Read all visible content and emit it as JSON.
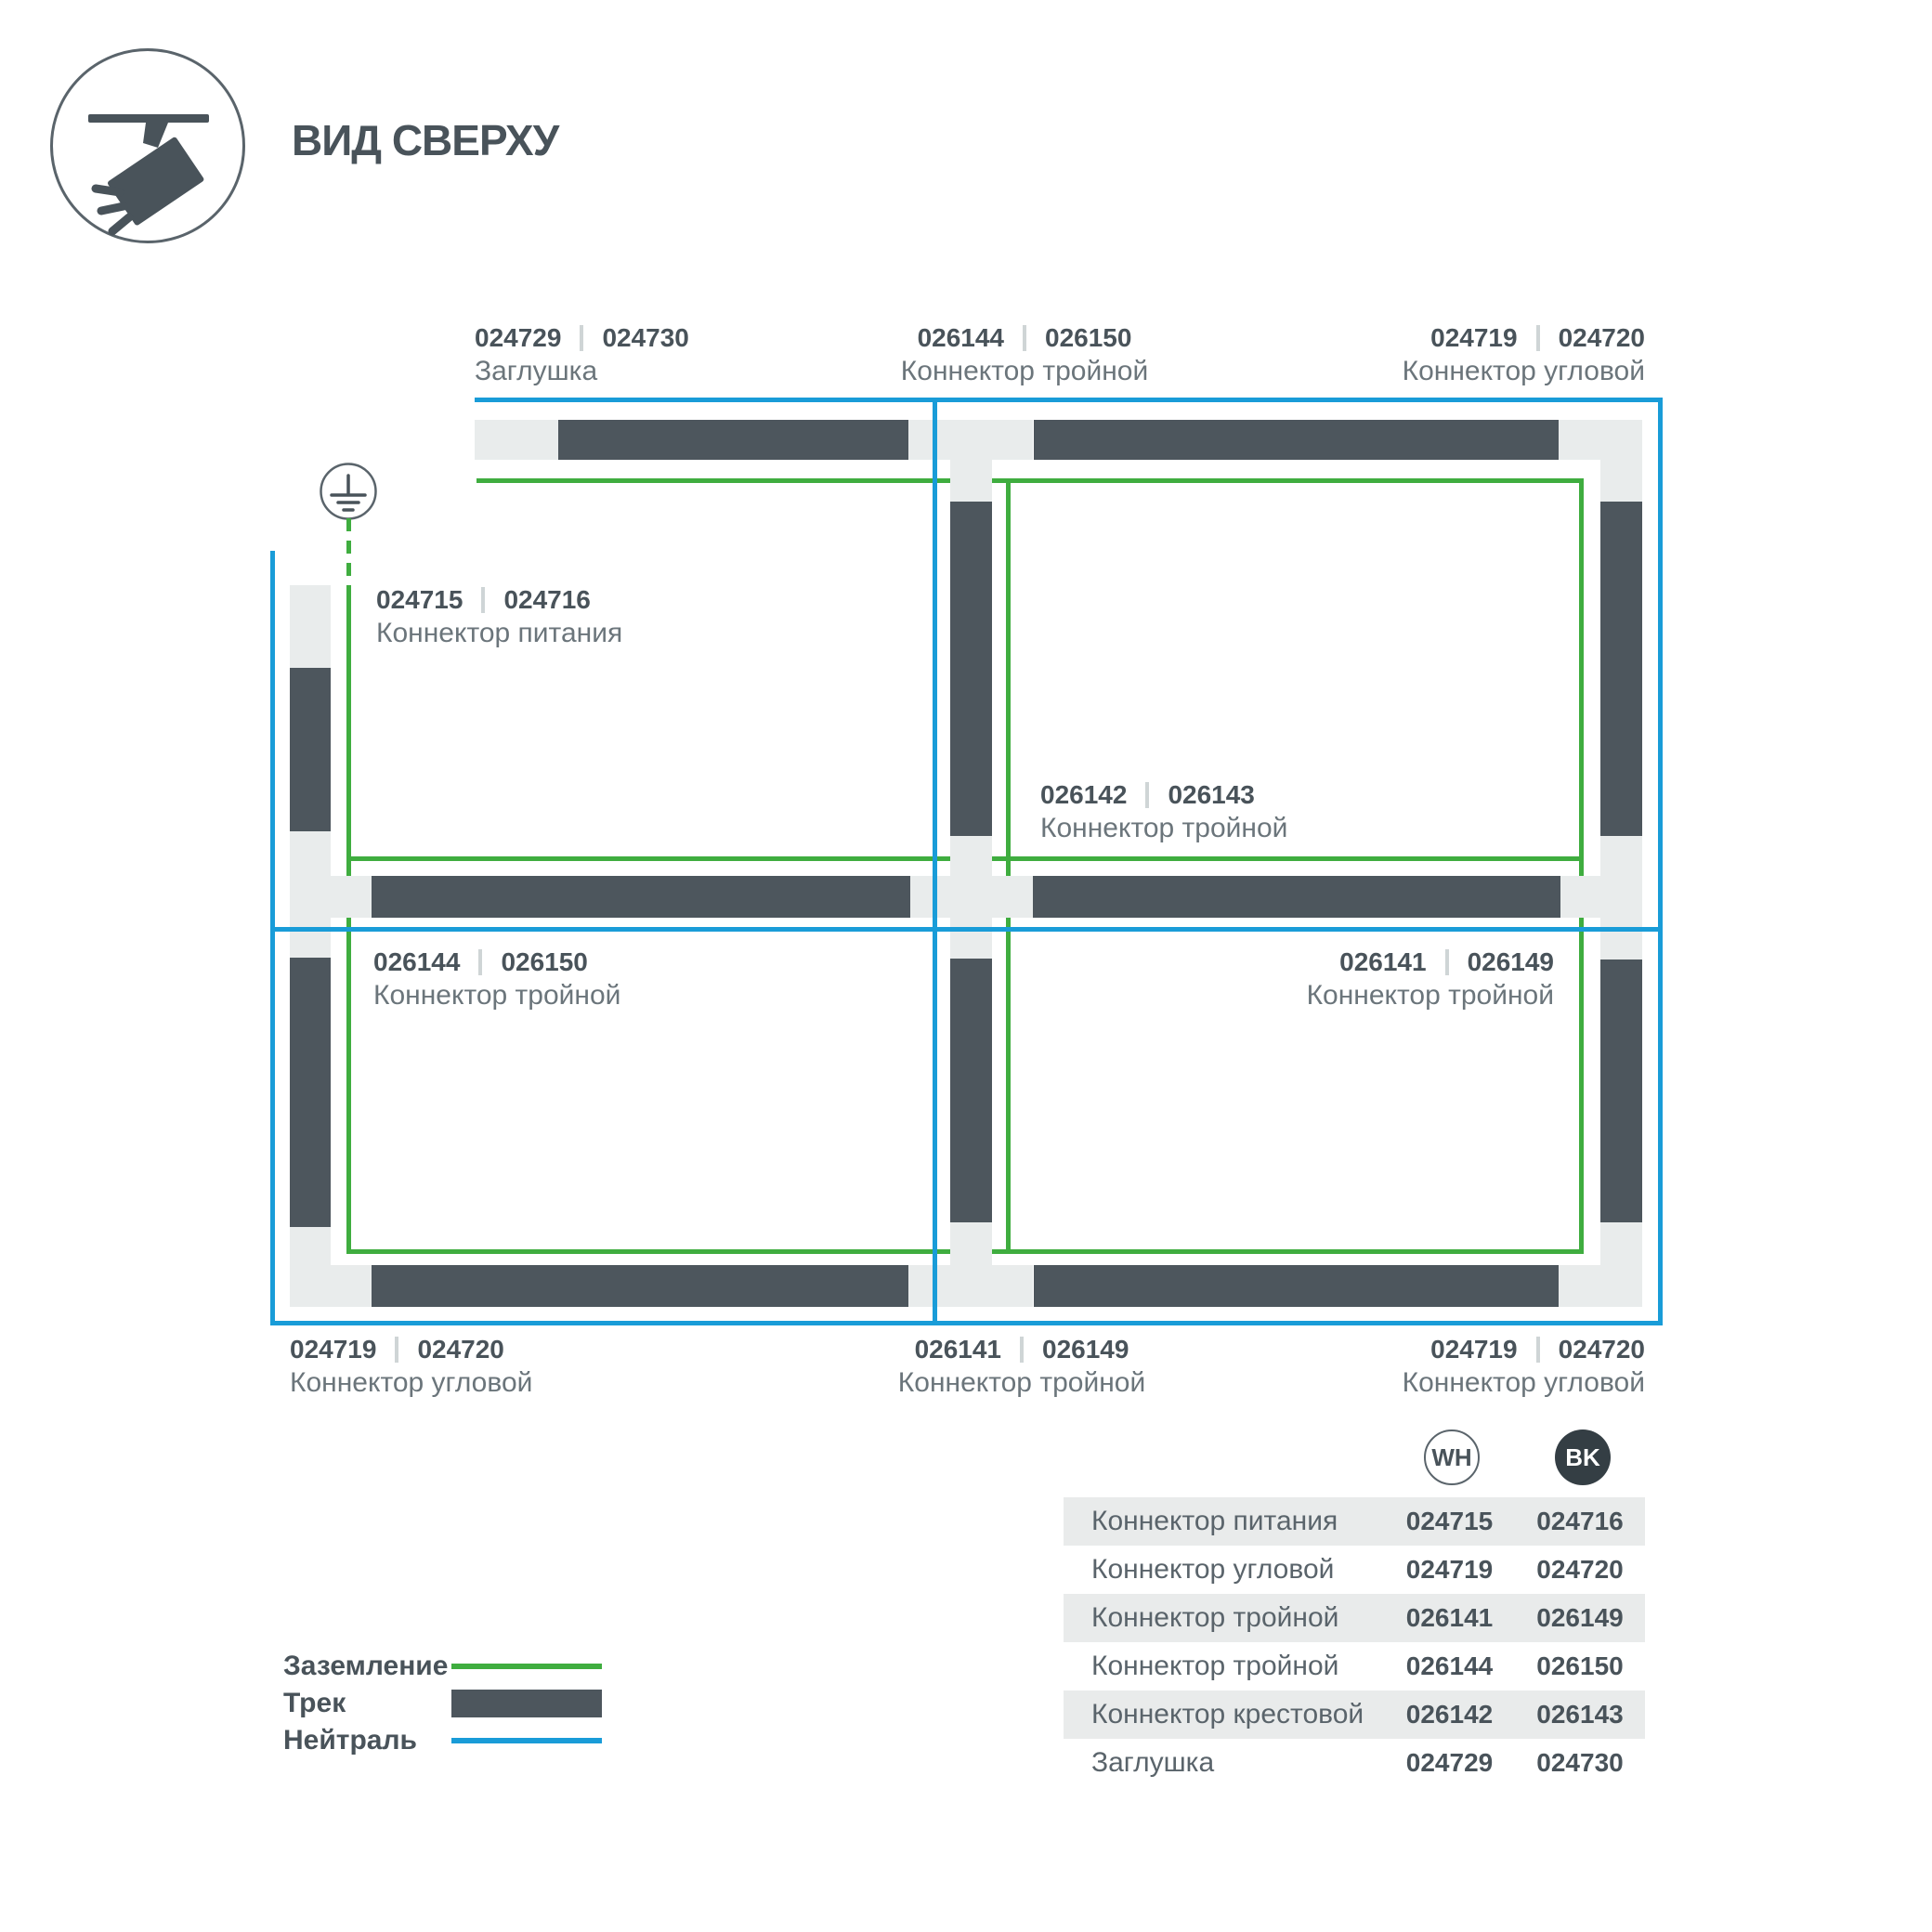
{
  "header": {
    "title": "ВИД СВЕРХУ",
    "icon": "track-spotlight-icon"
  },
  "diagram": {
    "ground_icon": "earth-ground-icon",
    "labels": {
      "top_left": {
        "code_wh": "024729",
        "code_bk": "024730",
        "name": "Заглушка"
      },
      "top_center": {
        "code_wh": "026144",
        "code_bk": "026150",
        "name": "Коннектор тройной"
      },
      "top_right": {
        "code_wh": "024719",
        "code_bk": "024720",
        "name": "Коннектор угловой"
      },
      "cell_top_left": {
        "code_wh": "024715",
        "code_bk": "024716",
        "name": "Коннектор питания"
      },
      "cell_center": {
        "code_wh": "026142",
        "code_bk": "026143",
        "name": "Коннектор тройной"
      },
      "cell_mid_left": {
        "code_wh": "026144",
        "code_bk": "026150",
        "name": "Коннектор тройной"
      },
      "cell_mid_right": {
        "code_wh": "026141",
        "code_bk": "026149",
        "name": "Коннектор тройной"
      },
      "bottom_left": {
        "code_wh": "024719",
        "code_bk": "024720",
        "name": "Коннектор угловой"
      },
      "bottom_center": {
        "code_wh": "026141",
        "code_bk": "026149",
        "name": "Коннектор тройной"
      },
      "bottom_right": {
        "code_wh": "024719",
        "code_bk": "024720",
        "name": "Коннектор угловой"
      }
    },
    "colors": {
      "ground_wire": "#3FAD3F",
      "neutral_wire": "#199CD8",
      "track_dark": "#4D565D",
      "track_light": "#E9ECEC"
    }
  },
  "legend": {
    "items": [
      {
        "label": "Заземление",
        "swatch": "green-line"
      },
      {
        "label": "Трек",
        "swatch": "dark-track-bar"
      },
      {
        "label": "Нейтраль",
        "swatch": "blue-line"
      }
    ]
  },
  "table": {
    "columns": [
      {
        "id": "wh",
        "badge": "WH"
      },
      {
        "id": "bk",
        "badge": "BK"
      }
    ],
    "rows": [
      {
        "name": "Коннектор питания",
        "wh": "024715",
        "bk": "024716"
      },
      {
        "name": "Коннектор угловой",
        "wh": "024719",
        "bk": "024720"
      },
      {
        "name": "Коннектор тройной",
        "wh": "026141",
        "bk": "026149"
      },
      {
        "name": "Коннектор тройной",
        "wh": "026144",
        "bk": "026150"
      },
      {
        "name": "Коннектор крестовой",
        "wh": "026142",
        "bk": "026143"
      },
      {
        "name": "Заглушка",
        "wh": "024729",
        "bk": "024730"
      }
    ]
  }
}
